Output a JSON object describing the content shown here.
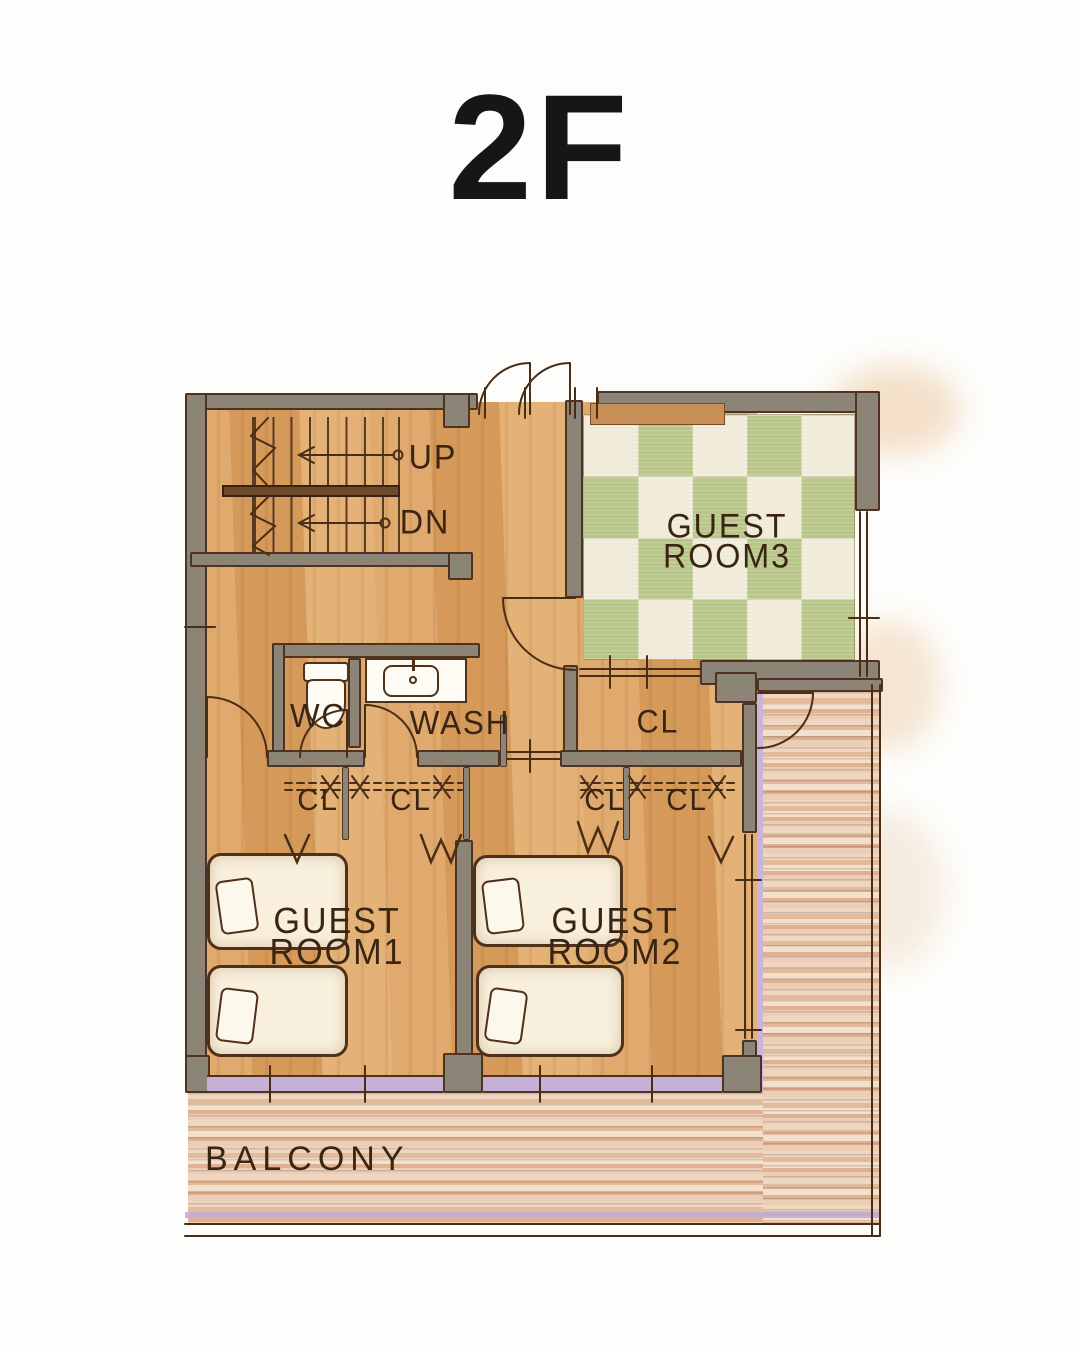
{
  "title": "2F",
  "palette": {
    "wood": "#dca76b",
    "wall_gray": "#8d8478",
    "outline_brown": "#4e3420",
    "tatami_green": "#b9c786",
    "tatami_cream": "#f0ebd8",
    "deck_tan": "#e9cdb4",
    "glass_purple": "#c6b0d6",
    "bed_cream": "#f8f0dd",
    "fixture_white": "#fdfbf4",
    "label_brown": "#3a2412",
    "title_black": "#161616"
  },
  "stairs": {
    "up_label": "UP",
    "down_label": "DN"
  },
  "rooms": {
    "guest_room_3": {
      "line1": "GUEST",
      "line2": "ROOM3"
    },
    "guest_room_1": {
      "line1": "GUEST",
      "line2": "ROOM1"
    },
    "guest_room_2": {
      "line1": "GUEST",
      "line2": "ROOM2"
    },
    "wc": {
      "label": "WC"
    },
    "wash": {
      "label": "WASH"
    },
    "closet": {
      "label": "CL"
    },
    "balcony": {
      "label": "BALCONY"
    }
  },
  "icons": [
    "toilet-icon",
    "sink-icon",
    "stair-up-arrow-icon",
    "stair-down-arrow-icon",
    "door-arc-icon",
    "casement-window-icon",
    "closet-hanger-icon"
  ]
}
